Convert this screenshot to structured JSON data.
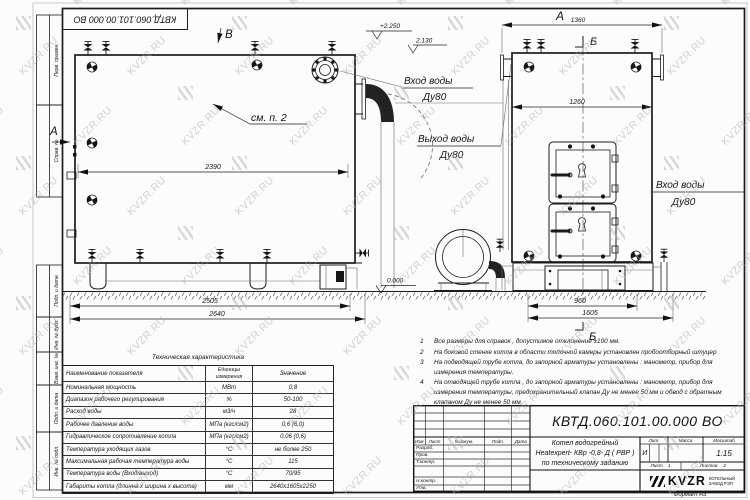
{
  "watermark": {
    "text": "KVZR.RU"
  },
  "frame": {
    "top_stamp": "КВТД.060.101.00.000  ВО",
    "margin_labels": [
      "Перв. примен.",
      "Справ. №",
      "Подп. и дата",
      "Инв. № дубл.",
      "Взам. инв. №",
      "Подп. и дата",
      "Инв. № подл."
    ]
  },
  "drawing": {
    "view_b": "В",
    "view_a_arrow": "А",
    "front_view": "А",
    "section": "Б",
    "see_item": "см. п. 2",
    "elev_2250": "+2.250",
    "elev_2130": "2.130",
    "elev_0": "0.000",
    "dim_2390": "2390",
    "dim_2505": "2505",
    "dim_2640": "2640",
    "dim_1360": "1360",
    "dim_1260": "1260",
    "dim_960": "960",
    "dim_1605": "1605",
    "inlet_1": "Вход воды",
    "inlet_1_dn": "Ду80",
    "outlet": "Выход воды",
    "outlet_dn": "Ду80",
    "inlet_2": "Вход воды",
    "inlet_2_dn": "Ду80"
  },
  "notes": {
    "items": [
      {
        "num": "1",
        "text": "Все размеры для справок , допустимое отклонение  ±100 мм."
      },
      {
        "num": "2",
        "text": "На боковой стенке котла в области топочной камеры установлен пробоотборный штуцер"
      },
      {
        "num": "3",
        "text": "На  подводящей трубе котла, до запорной арматуры установлены : манометр, прибор для измерения температуры."
      },
      {
        "num": "4",
        "text": "На отводящей трубе котла , до запорной арматуры установлены : манометр, прибор для измерения температуры, предохранительный клапан  Ду не менее  50 мм и обвод с обратным клапаном  Ду не менее 50 мм."
      }
    ]
  },
  "tech_table": {
    "title": "Техническая характеристика",
    "col_name": "Наименование показателя",
    "col_units": "Единицы измерения",
    "col_value": "Значение",
    "rows": [
      [
        "Номинальная мощность",
        "МВт",
        "0,8"
      ],
      [
        "Диапазон рабочего регулирования",
        "%",
        "50-100"
      ],
      [
        "Расход воды",
        "м3/ч",
        "28"
      ],
      [
        "Рабочее давление воды",
        "МПа (кгс/см2)",
        "0,6 (6,0)"
      ],
      [
        "Гидравлическое сопротивление котла",
        "МПа (кгс/см2)",
        "0,06 (0,6)"
      ],
      [
        "Температура уходящих газов",
        "°С",
        "не более 250"
      ],
      [
        "Максимальная рабочая температура воды",
        "°С",
        "115"
      ],
      [
        "Температура воды (Вход/выход)",
        "°С",
        "70/95"
      ],
      [
        "Габариты котла (длинна х ширина х высота)",
        "мм",
        "2640х1605х2250"
      ]
    ]
  },
  "title_block": {
    "doc_number": "КВТД.060.101.00.000  ВО",
    "col_izm": "Изм",
    "col_list": "Лист",
    "col_doc": "N докум.",
    "col_sign": "Подп.",
    "col_date": "Дата",
    "role_1": "Разраб.",
    "role_2": "Пров.",
    "role_3": "Т.контр.",
    "role_4": "Н.контр.",
    "role_5": "Утв.",
    "name_line_1": "Котел водогрейный",
    "name_line_2": "Heatexpert- КВр -0,8- Д ( РВР )",
    "name_line_3": "по техническому заданию",
    "lit_label": "Лит.",
    "lit_value": "И",
    "mass_label": "Масса",
    "scale_label": "Масштаб",
    "scale_value": "1:15",
    "sheet_label": "Лист",
    "sheet_num": "1",
    "sheets_label": "Листов",
    "sheets_num": "2",
    "company_short": "KVZR",
    "company_line_1": "КОТЕЛЬНЫЙ",
    "company_line_2": "ЗАВОД РЭП",
    "format_note": "Формат  А3"
  }
}
